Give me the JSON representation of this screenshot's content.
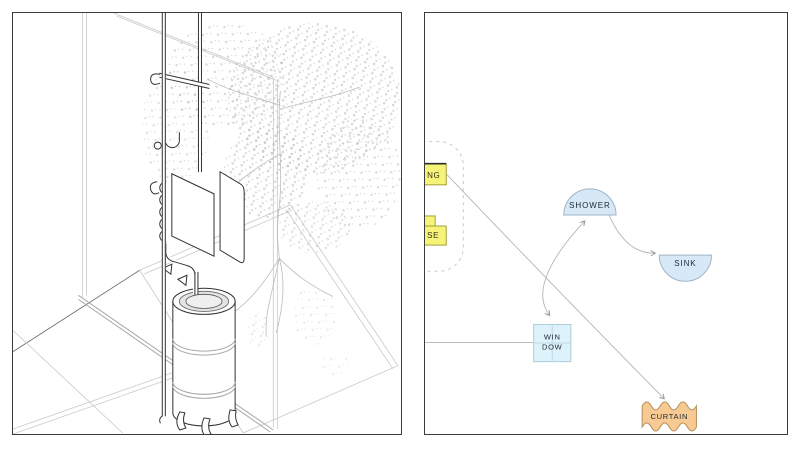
{
  "canvas": {
    "background": "#ffffff",
    "panel_border_color": "#3b3b3b"
  },
  "left_panel": {
    "drawing_parts": {
      "wall": "glass-wall-panel-sketch",
      "tree": "courtyard-tree-stipple-sketch",
      "pipes": "vertical-supply-pipes",
      "coil": "coil-heat-exchanger-plate",
      "flap": "hinged-flap-panel",
      "tank": "cylindrical-water-tank-on-legs",
      "floor": "isometric-floor-lines"
    }
  },
  "right_panel": {
    "label_color": "#1d2734",
    "arrow_color": "#b5b5b5",
    "dashed_outline_color": "#c8c8c8",
    "nodes": {
      "box_top": {
        "label": "NG",
        "fill": "#f7f378",
        "stroke": "#a3a03a",
        "top_edge": "#2a2a2a"
      },
      "box_bottom": {
        "label": "SE",
        "fill": "#f7f378",
        "stroke": "#a3a03a"
      },
      "shower": {
        "label": "SHOWER",
        "fill": "#d7e8f6",
        "stroke": "#9fb4c6"
      },
      "sink": {
        "label": "SINK",
        "fill": "#d7e8f6",
        "stroke": "#9fb4c6"
      },
      "window": {
        "label_lines": [
          "WIN",
          "DOW"
        ],
        "fill": "#ddf2fa",
        "stroke": "#accdd8",
        "mullion": "#b9d8e2"
      },
      "curtain": {
        "label": "CURTAIN",
        "fill": "#f6ca92",
        "stroke": "#b8905a"
      }
    }
  }
}
